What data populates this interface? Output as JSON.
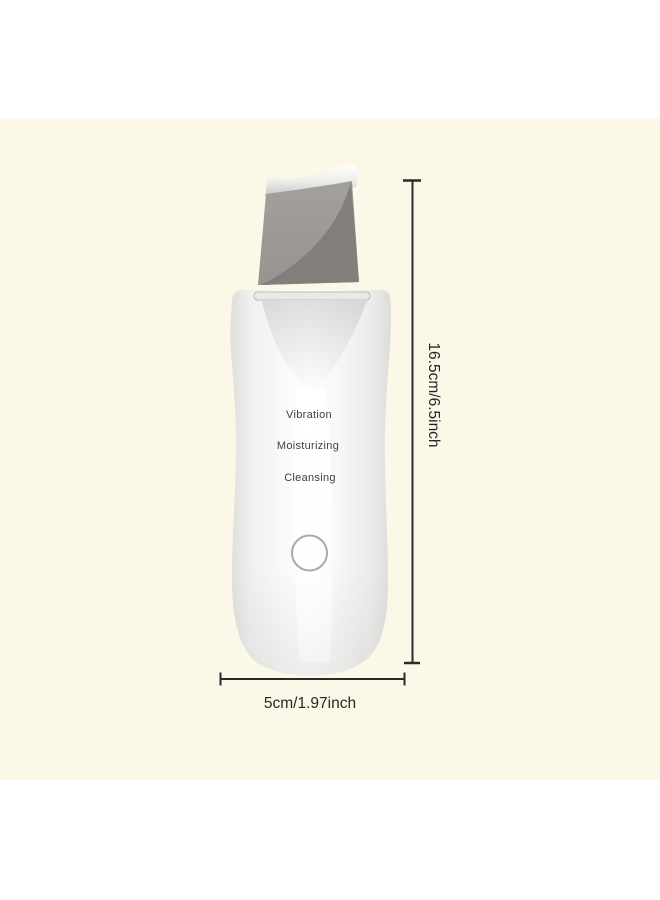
{
  "product": {
    "type": "ultrasonic-skin-scrubber",
    "features": [
      "Vibration",
      "Moisturizing",
      "Cleansing"
    ]
  },
  "dimensions": {
    "height_label": "16.5cm/6.5inch",
    "width_label": "5cm/1.97inch"
  },
  "colors": {
    "photo_background": "#fcf8e8",
    "page_background": "#ffffff",
    "blade_light_gray": "#9d9996",
    "blade_dark_gray": "#817e7b",
    "body_white": "#fdfdfc",
    "dimension_line": "#2a2a2a",
    "feature_text": "#3f3f3f",
    "dimension_text": "#262626",
    "power_button_ring": "#a6abab"
  }
}
